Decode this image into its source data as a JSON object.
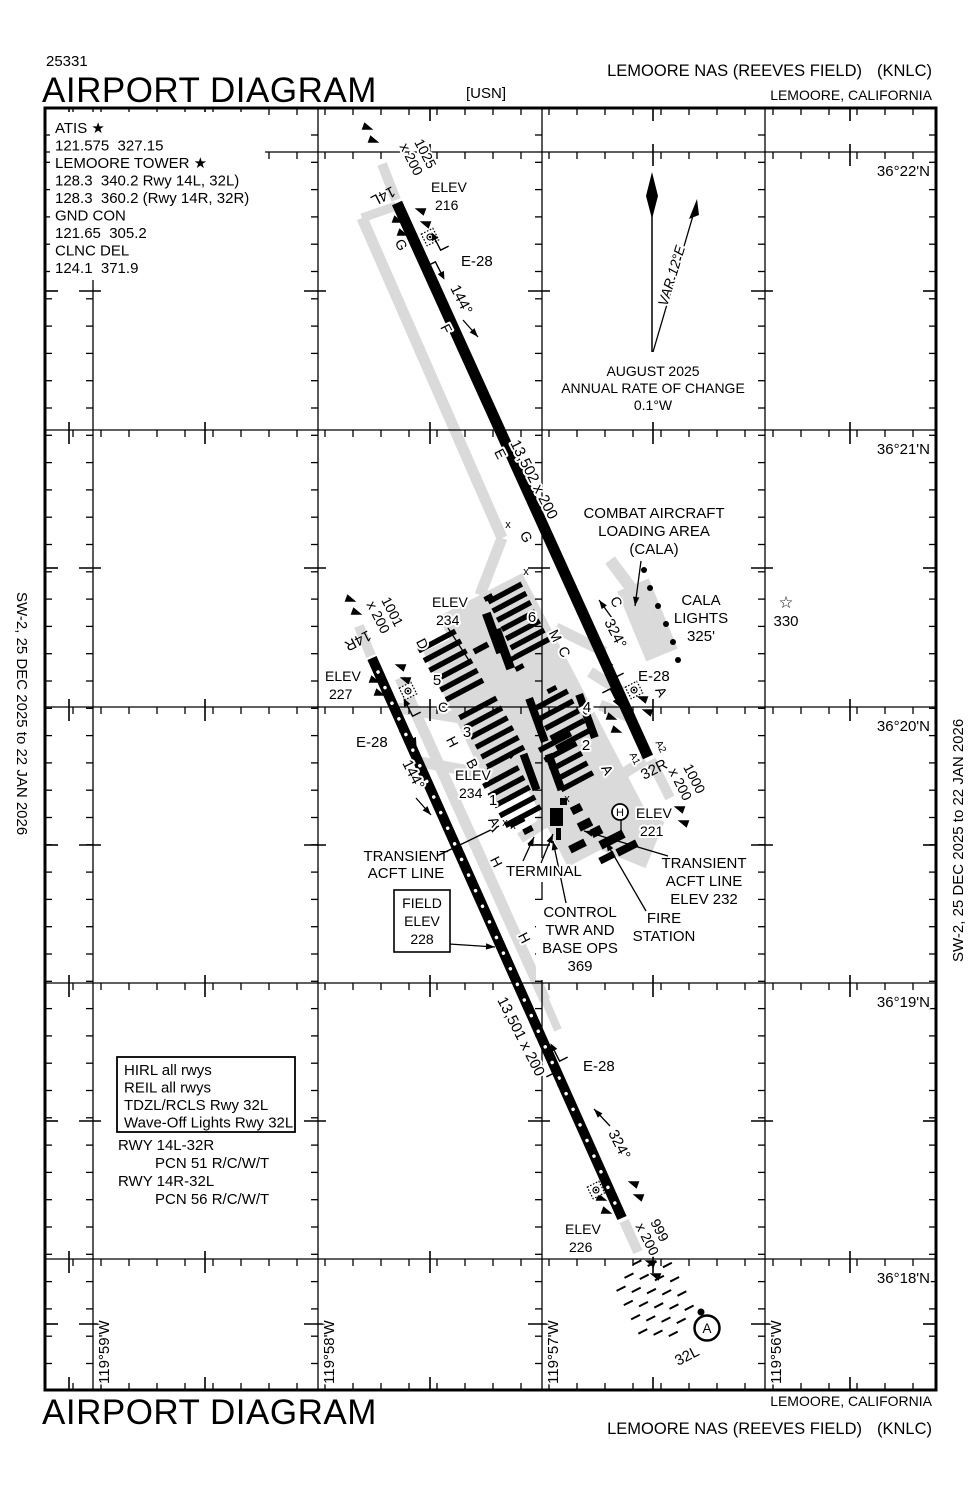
{
  "header": {
    "chart_id": "25331",
    "title": "AIRPORT DIAGRAM",
    "branch": "[USN]",
    "airport": "LEMOORE NAS (REEVES FIELD)",
    "icao": "(KNLC)",
    "location": "LEMOORE, CALIFORNIA"
  },
  "footer": {
    "title": "AIRPORT DIAGRAM",
    "airport": "LEMOORE NAS (REEVES FIELD)",
    "icao": "(KNLC)",
    "location": "LEMOORE, CALIFORNIA"
  },
  "edges": {
    "left": "SW-2, 25 DEC 2025 to 22 JAN 2026",
    "right": "SW-2, 25 DEC 2025 to 22 JAN 2026"
  },
  "comm": {
    "lines": [
      "ATIS ★",
      "121.575  327.15",
      "LEMOORE TOWER ★",
      "128.3  340.2 Rwy 14L, 32L)",
      "128.3  360.2 (Rwy 14R, 32R)",
      "GND CON",
      "121.65  305.2",
      "CLNC DEL",
      "124.1  371.9"
    ]
  },
  "variation": {
    "label": "VAR 12°E",
    "date": "AUGUST 2025",
    "rate_line": "ANNUAL RATE OF CHANGE",
    "rate_value": "0.1°W"
  },
  "grid": {
    "lats": [
      "36°22'N",
      "36°21'N",
      "36°20'N",
      "36°19'N",
      "36°18'N"
    ],
    "lons": [
      "119°59'W",
      "119°58'W",
      "119°57'W",
      "119°56'W"
    ]
  },
  "runways": {
    "arresting_gear": "E-28",
    "r1": {
      "id_n": "14L",
      "id_s": "32R",
      "dim": "13,502 x 200",
      "hdg_n": "144°",
      "hdg_s": "324°",
      "elev_label": "ELEV",
      "elev_n": "216",
      "overrun_n1": "1025",
      "overrun_n2": "x 200",
      "overrun_s1": "1000",
      "overrun_s2": "x 200"
    },
    "r2": {
      "id_n": "14R",
      "id_s": "32L",
      "dim": "13,501 x 200",
      "hdg_n": "144°",
      "hdg_s": "324°",
      "elev_label": "ELEV",
      "elev_n": "227",
      "elev_s": "226",
      "overrun_n1": "1001",
      "overrun_n2": "x 200",
      "overrun_s1": "999",
      "overrun_s2": "x 200"
    }
  },
  "twy": {
    "a": "A",
    "a1": "A1",
    "a2": "A2",
    "b": "B",
    "c": "C",
    "d": "D",
    "e": "E",
    "f": "F",
    "g": "G",
    "h": "H",
    "m": "M",
    "x_mark": "x"
  },
  "aprons": {
    "n1": "1",
    "n2": "2",
    "n3": "3",
    "n4": "4",
    "n5": "5",
    "n6": "6",
    "elev_label": "ELEV",
    "elev_234": "234"
  },
  "features": {
    "cala": [
      "COMBAT AIRCRAFT",
      "LOADING AREA",
      "(CALA)"
    ],
    "cala_lights": [
      "CALA",
      "LIGHTS",
      "325'"
    ],
    "beacon_star": "☆",
    "beacon": "330",
    "helipad": "H",
    "heli_elev": [
      "ELEV",
      "221"
    ],
    "terminal": "TERMINAL",
    "control_tower": [
      "CONTROL",
      "TWR AND",
      "BASE OPS",
      "369"
    ],
    "fire_station": [
      "FIRE",
      "STATION"
    ],
    "transient_w": [
      "TRANSIENT",
      "ACFT LINE"
    ],
    "transient_e": [
      "TRANSIENT",
      "ACFT LINE",
      "ELEV 232"
    ],
    "field_elev": [
      "FIELD",
      "ELEV",
      "228"
    ],
    "approach_light": "A"
  },
  "info_box": [
    "HIRL all rwys",
    "REIL all rwys",
    "TDZL/RCLS Rwy 32L",
    "Wave-Off Lights Rwy 32L"
  ],
  "pcn": [
    "RWY 14L-32R",
    "PCN 51 R/C/W/T",
    "RWY 14R-32L",
    "PCN 56 R/C/W/T"
  ]
}
